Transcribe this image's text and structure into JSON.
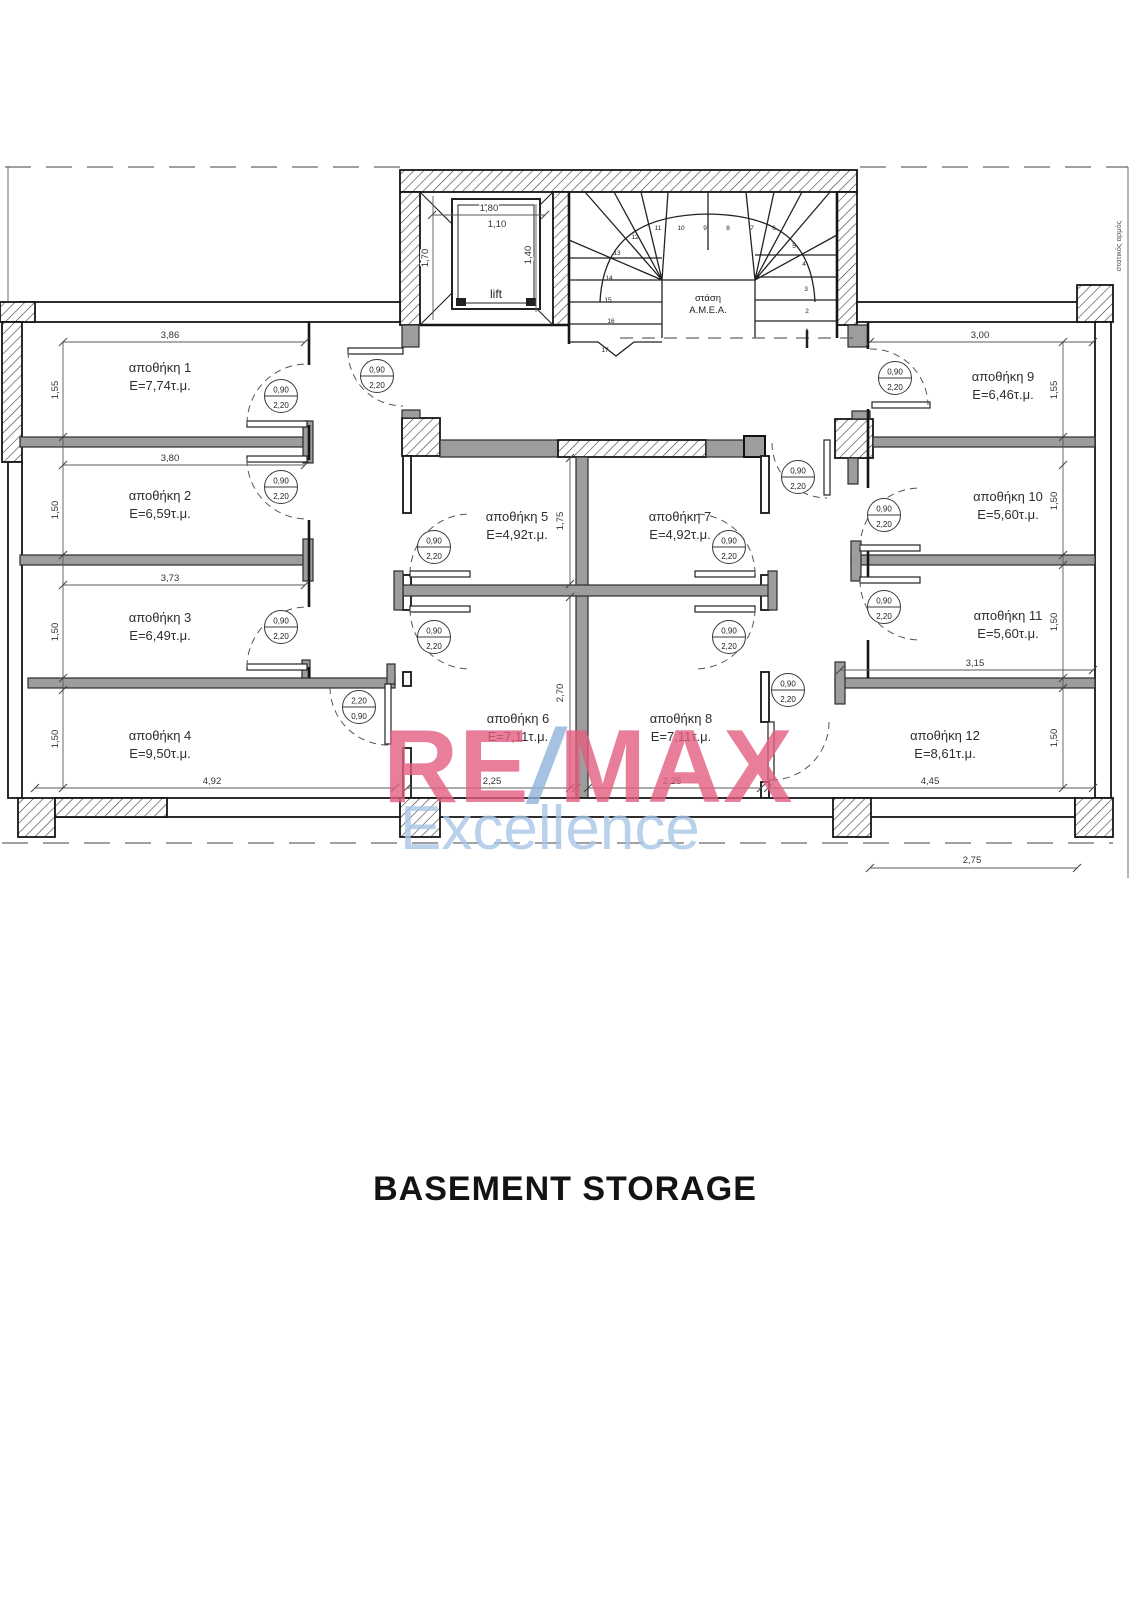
{
  "page": {
    "title": "BASEMENT STORAGE"
  },
  "watermark": {
    "re": "RE",
    "slash": "/",
    "max": "MAX",
    "subtitle": "Excellence",
    "color_pink": "#e35f80",
    "color_blue": "#8fb3dc",
    "color_subtitle": "#a9c6e8"
  },
  "site_note": "στατικός αρμός",
  "core": {
    "lift": {
      "label": "lift",
      "dim_width": "1,80",
      "dim_width_inner": "1,10",
      "dim_height_left": "1,70",
      "dim_height_right": "1,40"
    },
    "stair": {
      "landing_label_line1": "στάση",
      "landing_label_line2": "Α.Μ.Ε.Α.",
      "steps": [
        "1",
        "2",
        "3",
        "4",
        "5",
        "6",
        "7",
        "8",
        "9",
        "10",
        "11",
        "12",
        "13",
        "14",
        "15",
        "16",
        "17"
      ]
    }
  },
  "rooms": [
    {
      "name": "αποθήκη 1",
      "area": "E=7,74τ.μ."
    },
    {
      "name": "αποθήκη 2",
      "area": "E=6,59τ.μ."
    },
    {
      "name": "αποθήκη 3",
      "area": "E=6,49τ.μ."
    },
    {
      "name": "αποθήκη 4",
      "area": "E=9,50τ.μ."
    },
    {
      "name": "αποθήκη 5",
      "area": "E=4,92τ.μ."
    },
    {
      "name": "αποθήκη 6",
      "area": "E=7,11τ.μ."
    },
    {
      "name": "αποθήκη 7",
      "area": "E=4,92τ.μ."
    },
    {
      "name": "αποθήκη 8",
      "area": "E=7,11τ.μ."
    },
    {
      "name": "αποθήκη 9",
      "area": "E=6,46τ.μ."
    },
    {
      "name": "αποθήκη 10",
      "area": "E=5,60τ.μ."
    },
    {
      "name": "αποθήκη 11",
      "area": "E=5,60τ.μ."
    },
    {
      "name": "αποθήκη 12",
      "area": "E=8,61τ.μ."
    }
  ],
  "door_labels": {
    "standard": {
      "width": "0,90",
      "height": "2,20"
    },
    "reversed": {
      "width": "2,20",
      "height": "0,90"
    }
  },
  "dimensions": {
    "left_wing": {
      "room1_width": "3,86",
      "room1_depth": "1,55",
      "room2_width": "3,80",
      "room2_depth": "1,50",
      "room3_width": "3,73",
      "room3_depth": "1,50",
      "room4_width": "4,92",
      "room4_depth": "1,50"
    },
    "center": {
      "room6_width": "2,25",
      "room8_width": "2,25",
      "spine_upper": "1,75",
      "spine_lower": "2,70"
    },
    "right_wing": {
      "room9_width": "3,00",
      "room9_depth": "1,55",
      "room10_depth": "1,50",
      "room11_depth": "1,50",
      "room11_width": "3,15",
      "room12_depth": "1,50",
      "room12_width": "4,45",
      "offset_bottom": "2,75"
    }
  }
}
